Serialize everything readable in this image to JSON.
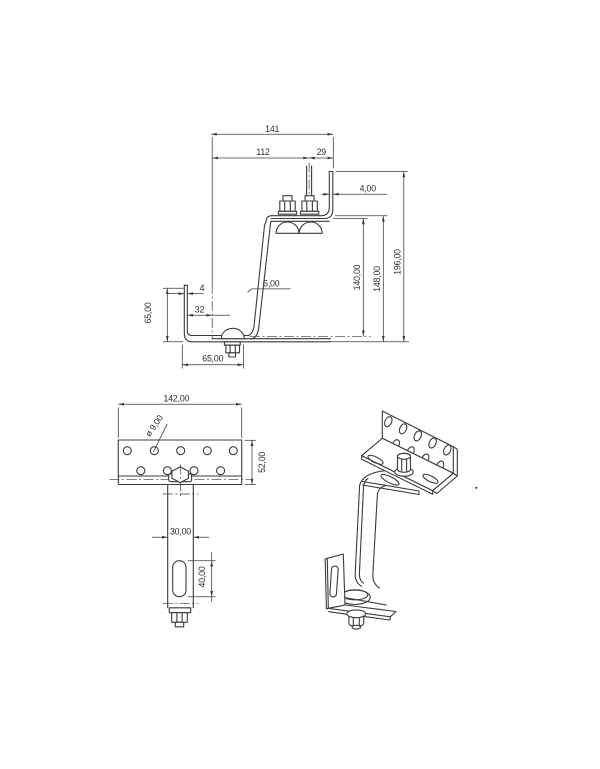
{
  "meta": {
    "drawing_type": "technical-drawing-roof-hook",
    "background": "#ffffff",
    "line_color": "#3b3b3b",
    "text_color": "#2e2e2e"
  },
  "front_view": {
    "dims": {
      "overall_width": "141",
      "left_span": "112",
      "right_span": "29",
      "plate_thickness": "4,00",
      "overall_height": "196,00",
      "height_to_flange_top": "148,00",
      "height_to_flange_bottom": "140,00",
      "web_thickness": "5,00",
      "hook_height": "65,00",
      "hook_leg_thickness": "4",
      "slot_offset": "32",
      "hook_foot_length": "65,00"
    }
  },
  "plan_view": {
    "dims": {
      "plate_width": "142,00",
      "hole_diameter": "ø 9,00",
      "plate_depth": "52,00",
      "arm_width": "30,00",
      "slot_length": "40,00"
    }
  }
}
